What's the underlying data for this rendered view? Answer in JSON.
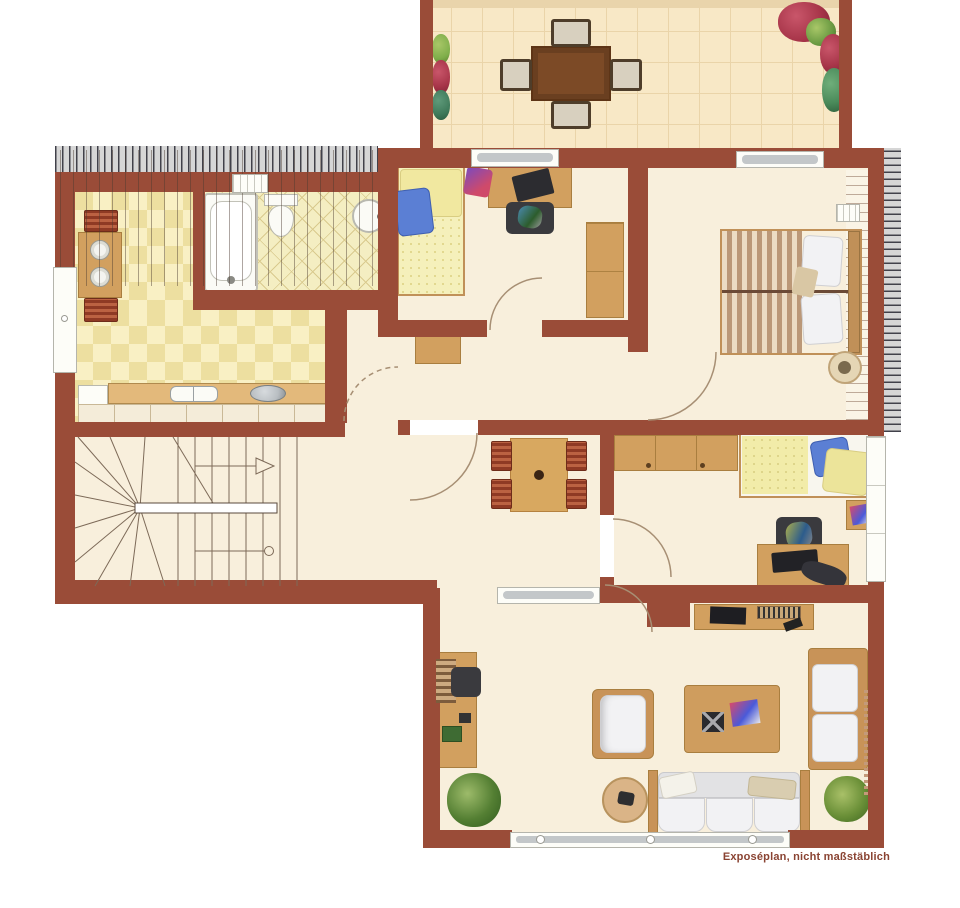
{
  "caption": {
    "text": "Exposéplan, nicht maßstäblich"
  },
  "palette": {
    "wall": "#9a4c38",
    "floor": "#f8efdc",
    "balcony_tile": "#f8e8c6",
    "kitchen_tile": "#f2e3a8",
    "bath_tile": "#f4eec2",
    "wood_furniture": "#d2a05f",
    "wood_dark": "#7c4a26",
    "bed_yellow": "#f2eca9",
    "pillow_blue": "#5b7fd4",
    "sofa_white": "#f2f2f4",
    "plant_green": "#547f33",
    "hatch_gray": "#d6d6d6",
    "caption_color": "#8a4332"
  },
  "plan": {
    "type": "floor-plan",
    "rooms": [
      {
        "id": "balcony",
        "furniture": [
          "dining-table",
          "four-chairs",
          "flower-boxes",
          "potted-plants"
        ]
      },
      {
        "id": "kitchen",
        "furniture": [
          "breakfast-table",
          "two-chairs",
          "two-plates",
          "counter-with-sink",
          "stove",
          "fridge"
        ]
      },
      {
        "id": "bathroom",
        "furniture": [
          "bathtub",
          "toilet",
          "washbasin",
          "radiator-window"
        ]
      },
      {
        "id": "bedroom-top",
        "furniture": [
          "single-bed",
          "desk-with-laptop",
          "office-chair",
          "wardrobe"
        ]
      },
      {
        "id": "master-bedroom",
        "furniture": [
          "double-bed",
          "two-pillows",
          "plant-pot",
          "radiator"
        ]
      },
      {
        "id": "bedroom-right",
        "furniture": [
          "single-bed",
          "closet",
          "desk",
          "office-chair",
          "nightstand"
        ]
      },
      {
        "id": "hallway",
        "furniture": [
          "square-table",
          "four-chairs"
        ]
      },
      {
        "id": "stairwell",
        "furniture": [
          "winder-staircase",
          "direction-arrow"
        ]
      },
      {
        "id": "living-room",
        "furniture": [
          "three-seat-sofa",
          "corner-sofa",
          "armchair",
          "coffee-table",
          "tv-sideboard",
          "desk",
          "office-chair",
          "round-side-table",
          "two-plants"
        ]
      }
    ]
  }
}
